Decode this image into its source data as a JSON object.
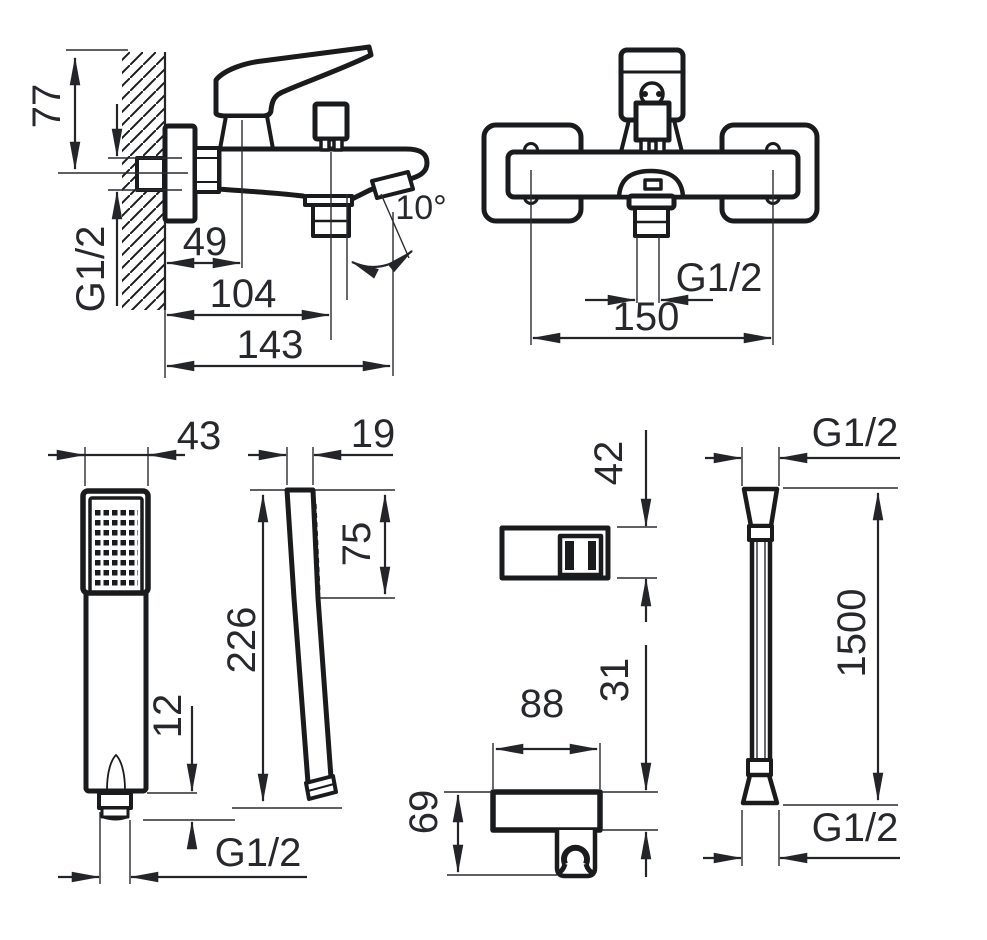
{
  "colors": {
    "background": "#ffffff",
    "line": "#1a1b1d",
    "text": "#26282c"
  },
  "views": {
    "mixer_side": {
      "dims": {
        "height": "77",
        "wall_thread": "G1/2",
        "cartridge_offset": "49",
        "outlet_offset": "104",
        "spout_reach": "143",
        "spout_angle": "10°"
      }
    },
    "mixer_front": {
      "dims": {
        "outlet_thread": "G1/2",
        "mount_spacing": "150"
      }
    },
    "handshower_front": {
      "dims": {
        "head_width": "43",
        "nut_height": "12",
        "thread": "G1/2"
      }
    },
    "handshower_side": {
      "dims": {
        "head_depth": "19",
        "head_length": "75",
        "total_length": "226"
      }
    },
    "holder_top": {
      "dims": {
        "depth": "42"
      }
    },
    "holder_front": {
      "dims": {
        "width": "88",
        "body_height": "31",
        "total_height": "69"
      }
    },
    "hose": {
      "dims": {
        "top_thread": "G1/2",
        "length": "1500",
        "bottom_thread": "G1/2"
      }
    }
  }
}
